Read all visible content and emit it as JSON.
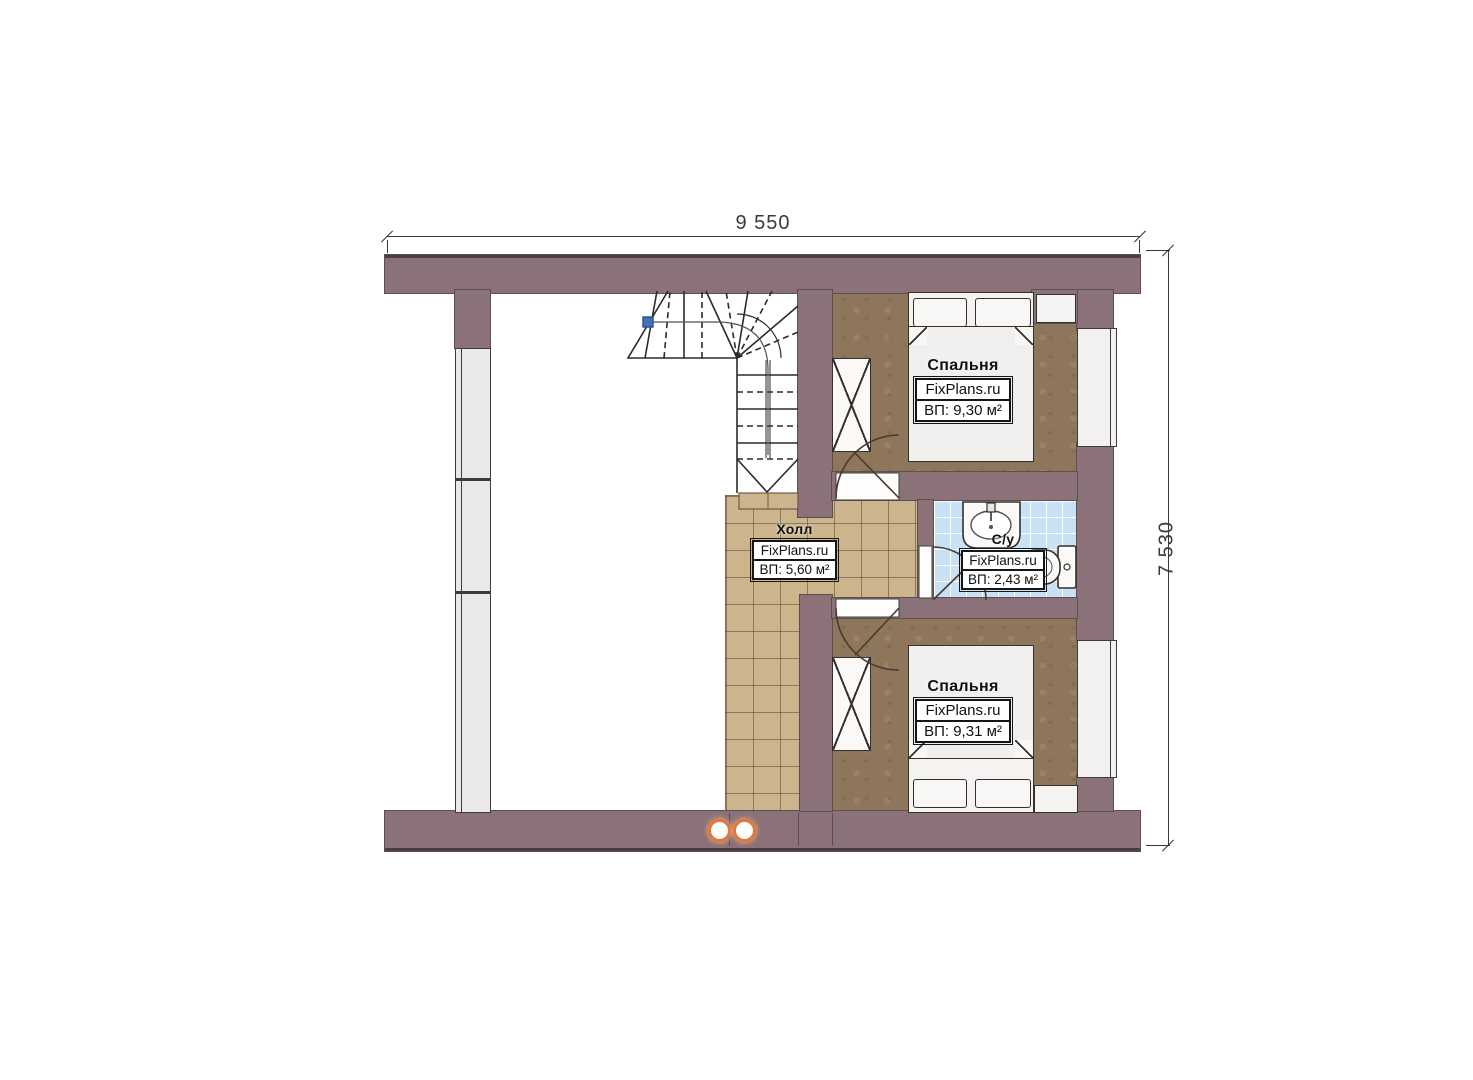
{
  "plan": {
    "watermark": "FixPlans.ru",
    "dimensions": {
      "top_label": "9 550",
      "right_label": "7 530"
    },
    "rooms": {
      "bedroom_top": {
        "name": "Спальня",
        "area": "ВП: 9,30 м²"
      },
      "hall": {
        "name": "Холл",
        "area": "ВП: 5,60 м²"
      },
      "bathroom": {
        "name": "С/у",
        "area": "ВП: 2,43 м²"
      },
      "bedroom_bottom": {
        "name": "Спальня",
        "area": "ВП: 9,31 м²"
      }
    }
  },
  "colors": {
    "wall": "#8b7278",
    "wall_edge": "#4a3e42",
    "bedroom_floor": "#8d7659",
    "hall_floor": "#ccb48c",
    "bathroom_floor": "#c9e1f5",
    "furniture_fill": "#f4f3f1",
    "line": "#33302d",
    "vent_ring": "#e0773e",
    "stair_node": "#4472b8",
    "dim_text": "#3a3a3a"
  }
}
